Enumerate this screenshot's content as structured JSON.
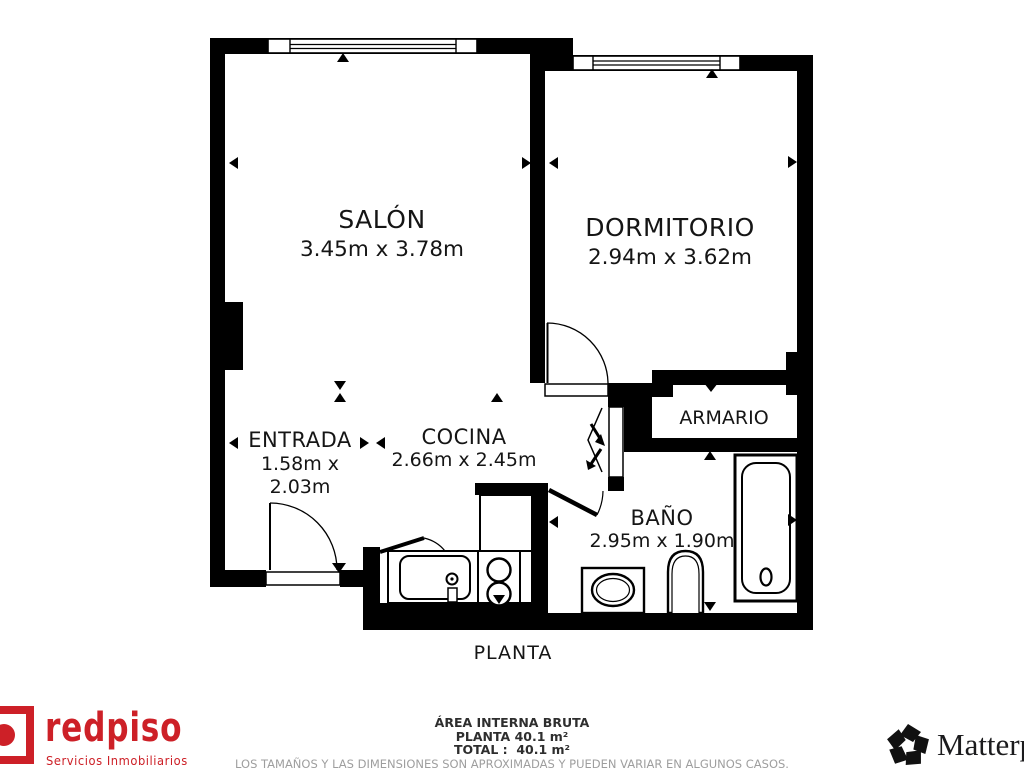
{
  "plan": {
    "title": "PLANTA",
    "wall_color": "#000000",
    "rooms": {
      "salon": {
        "name": "SALÓN",
        "dims": "3.45m x 3.78m"
      },
      "dormitorio": {
        "name": "DORMITORIO",
        "dims": "2.94m x 3.62m"
      },
      "entrada": {
        "name": "ENTRADA",
        "dims_line1": "1.58m x",
        "dims_line2": "2.03m"
      },
      "cocina": {
        "name": "COCINA",
        "dims": "2.66m x 2.45m"
      },
      "armario": {
        "name": "ARMARIO"
      },
      "bano": {
        "name": "BAÑO",
        "dims": "2.95m x 1.90m"
      }
    },
    "icons": {
      "measure_marker": "small solid triangle",
      "door": "quarter-arc swing",
      "folding_door": "zigzag"
    }
  },
  "footer": {
    "redpiso": {
      "brand": "redpiso",
      "tagline": "Servicios Inmobiliarios",
      "color": "#cd2027"
    },
    "area": {
      "line1": "ÁREA INTERNA BRUTA",
      "line2": "PLANTA 40.1 m²",
      "line3": "TOTAL :  40.1 m²",
      "disclaimer": "LOS TAMAÑOS Y LAS DIMENSIONES SON APROXIMADAS Y PUEDEN VARIAR EN ALGUNOS CASOS."
    },
    "matterport": {
      "brand": "Matterport",
      "icon": "pinwheel"
    }
  }
}
